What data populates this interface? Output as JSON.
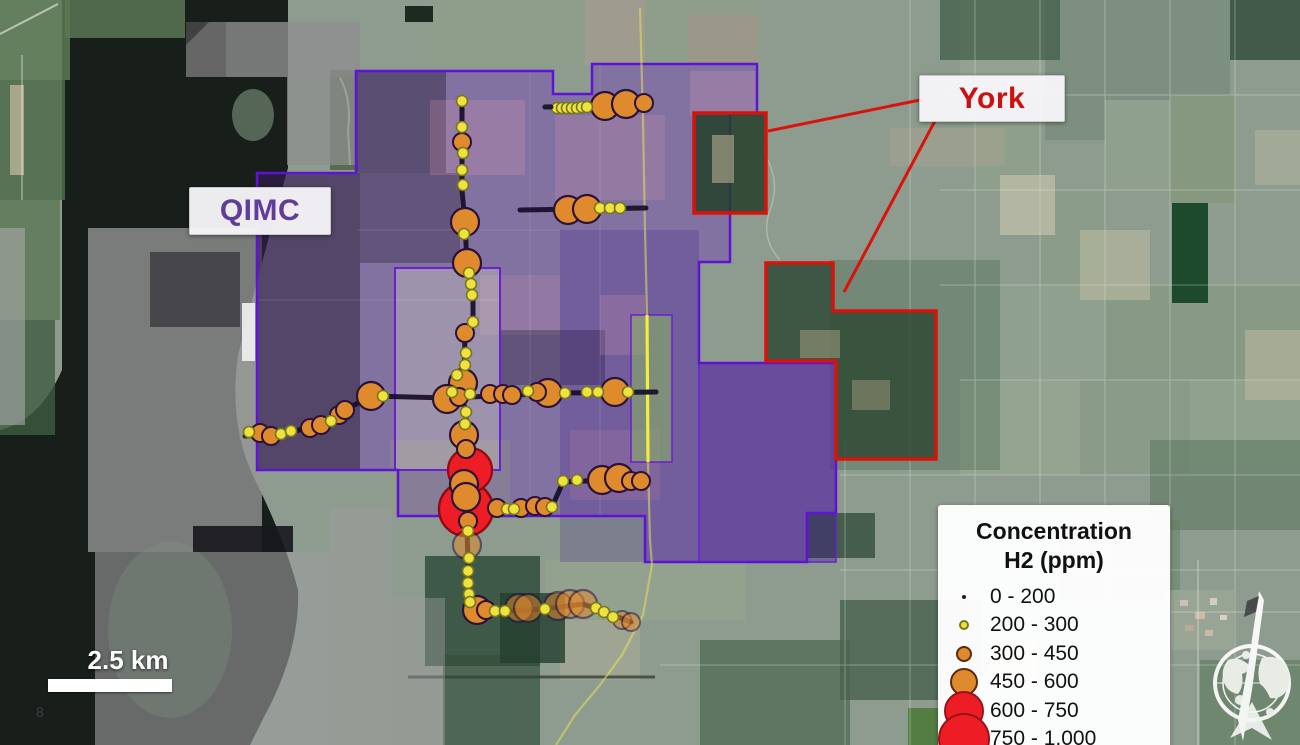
{
  "map": {
    "labels": {
      "qimc": "QIMC",
      "york": "York"
    },
    "scale_bar": {
      "label": "2.5 km"
    },
    "page_number": "8",
    "colors": {
      "qimc_outline": "#5e13d6",
      "qimc_label_text": "#5f3d99",
      "york_outline": "#d8130c",
      "york_label_text": "#cc1111",
      "dot_yellow": "#f0e23c",
      "dot_orange": "#e08a2e",
      "dot_red": "#ee1c24",
      "road_yellow": "#f1ea4a"
    },
    "legend": {
      "title_line1": "Concentration",
      "title_line2": "H2 (ppm)",
      "items": [
        {
          "range": "0 - 200",
          "color": "#1c1c30",
          "stroke": null,
          "radius": 2
        },
        {
          "range": "200 - 300",
          "color": "#f0e23c",
          "stroke": "#77771f",
          "radius": 5
        },
        {
          "range": "300 - 450",
          "color": "#e08a2e",
          "stroke": "#5a2a10",
          "radius": 8
        },
        {
          "range": "450 - 600",
          "color": "#e08a2e",
          "stroke": "#5a2a10",
          "radius": 14
        },
        {
          "range": "600 - 750",
          "color": "#ee1c24",
          "stroke": "#99121a",
          "radius": 20
        },
        {
          "range": "750 - 1,000",
          "color": "#ee1c24",
          "stroke": "#99121a",
          "radius": 26
        }
      ]
    },
    "dot_radii": {
      "c1": 2.5,
      "c2": 5.5,
      "c3": 9,
      "c4": 14,
      "c5": 22,
      "c6": 27
    },
    "points": [
      {
        "x": 545,
        "y": 107,
        "c": "c1"
      },
      {
        "x": 551,
        "y": 107,
        "c": "c1"
      },
      {
        "x": 557,
        "y": 108,
        "c": "c2"
      },
      {
        "x": 562,
        "y": 108,
        "c": "c2"
      },
      {
        "x": 567,
        "y": 108,
        "c": "c2"
      },
      {
        "x": 572,
        "y": 108,
        "c": "c2"
      },
      {
        "x": 577,
        "y": 108,
        "c": "c2"
      },
      {
        "x": 582,
        "y": 107,
        "c": "c2"
      },
      {
        "x": 587,
        "y": 107,
        "c": "c2"
      },
      {
        "x": 605,
        "y": 106,
        "c": "c4"
      },
      {
        "x": 626,
        "y": 104,
        "c": "c4"
      },
      {
        "x": 644,
        "y": 103,
        "c": "c3"
      },
      {
        "x": 462,
        "y": 101,
        "c": "c2"
      },
      {
        "x": 462,
        "y": 127,
        "c": "c2"
      },
      {
        "x": 462,
        "y": 142,
        "c": "c3"
      },
      {
        "x": 463,
        "y": 153,
        "c": "c2"
      },
      {
        "x": 462,
        "y": 170,
        "c": "c2"
      },
      {
        "x": 463,
        "y": 185,
        "c": "c2"
      },
      {
        "x": 465,
        "y": 222,
        "c": "c4"
      },
      {
        "x": 464,
        "y": 234,
        "c": "c2"
      },
      {
        "x": 467,
        "y": 263,
        "c": "c4"
      },
      {
        "x": 469,
        "y": 273,
        "c": "c2"
      },
      {
        "x": 471,
        "y": 284,
        "c": "c2"
      },
      {
        "x": 472,
        "y": 295,
        "c": "c2"
      },
      {
        "x": 473,
        "y": 322,
        "c": "c2"
      },
      {
        "x": 465,
        "y": 333,
        "c": "c3"
      },
      {
        "x": 466,
        "y": 353,
        "c": "c2"
      },
      {
        "x": 465,
        "y": 365,
        "c": "c2"
      },
      {
        "x": 457,
        "y": 375,
        "c": "c2"
      },
      {
        "x": 463,
        "y": 383,
        "c": "c4"
      },
      {
        "x": 452,
        "y": 392,
        "c": "c2"
      },
      {
        "x": 470,
        "y": 394,
        "c": "c2"
      },
      {
        "x": 447,
        "y": 399,
        "c": "c4"
      },
      {
        "x": 459,
        "y": 397,
        "c": "c3"
      },
      {
        "x": 466,
        "y": 412,
        "c": "c2"
      },
      {
        "x": 465,
        "y": 424,
        "c": "c2"
      },
      {
        "x": 464,
        "y": 435,
        "c": "c4"
      },
      {
        "x": 466,
        "y": 449,
        "c": "c3"
      },
      {
        "x": 470,
        "y": 470,
        "c": "c5"
      },
      {
        "x": 464,
        "y": 484,
        "c": "c4"
      },
      {
        "x": 466,
        "y": 497,
        "c": "c4"
      },
      {
        "x": 466,
        "y": 509,
        "c": "c6"
      },
      {
        "x": 468,
        "y": 521,
        "c": "c3"
      },
      {
        "x": 468,
        "y": 531,
        "c": "c2"
      },
      {
        "x": 467,
        "y": 545,
        "c": "c4",
        "f": 1
      },
      {
        "x": 469,
        "y": 558,
        "c": "c2"
      },
      {
        "x": 468,
        "y": 571,
        "c": "c2"
      },
      {
        "x": 468,
        "y": 583,
        "c": "c2"
      },
      {
        "x": 469,
        "y": 594,
        "c": "c2"
      },
      {
        "x": 470,
        "y": 602,
        "c": "c2"
      },
      {
        "x": 568,
        "y": 210,
        "c": "c4"
      },
      {
        "x": 587,
        "y": 209,
        "c": "c4"
      },
      {
        "x": 600,
        "y": 208,
        "c": "c2"
      },
      {
        "x": 610,
        "y": 208,
        "c": "c2"
      },
      {
        "x": 620,
        "y": 208,
        "c": "c2"
      },
      {
        "x": 633,
        "y": 208,
        "c": "c1"
      },
      {
        "x": 642,
        "y": 208,
        "c": "c1"
      },
      {
        "x": 490,
        "y": 394,
        "c": "c3"
      },
      {
        "x": 503,
        "y": 394,
        "c": "c3"
      },
      {
        "x": 512,
        "y": 395,
        "c": "c3"
      },
      {
        "x": 528,
        "y": 391,
        "c": "c2"
      },
      {
        "x": 537,
        "y": 392,
        "c": "c3"
      },
      {
        "x": 548,
        "y": 393,
        "c": "c4"
      },
      {
        "x": 565,
        "y": 393,
        "c": "c2"
      },
      {
        "x": 587,
        "y": 392,
        "c": "c2"
      },
      {
        "x": 598,
        "y": 392,
        "c": "c2"
      },
      {
        "x": 615,
        "y": 392,
        "c": "c4"
      },
      {
        "x": 628,
        "y": 392,
        "c": "c2"
      },
      {
        "x": 640,
        "y": 392,
        "c": "c1"
      },
      {
        "x": 648,
        "y": 392,
        "c": "c1"
      },
      {
        "x": 656,
        "y": 392,
        "c": "c1"
      },
      {
        "x": 497,
        "y": 508,
        "c": "c3"
      },
      {
        "x": 507,
        "y": 509,
        "c": "c2"
      },
      {
        "x": 514,
        "y": 509,
        "c": "c2"
      },
      {
        "x": 521,
        "y": 508,
        "c": "c3"
      },
      {
        "x": 535,
        "y": 506,
        "c": "c3"
      },
      {
        "x": 545,
        "y": 507,
        "c": "c3"
      },
      {
        "x": 552,
        "y": 507,
        "c": "c2"
      },
      {
        "x": 563,
        "y": 481,
        "c": "c2"
      },
      {
        "x": 577,
        "y": 480,
        "c": "c2"
      },
      {
        "x": 602,
        "y": 480,
        "c": "c4"
      },
      {
        "x": 619,
        "y": 478,
        "c": "c4"
      },
      {
        "x": 631,
        "y": 481,
        "c": "c3"
      },
      {
        "x": 641,
        "y": 481,
        "c": "c3"
      },
      {
        "x": 249,
        "y": 432,
        "c": "c2"
      },
      {
        "x": 260,
        "y": 433,
        "c": "c3"
      },
      {
        "x": 271,
        "y": 436,
        "c": "c3"
      },
      {
        "x": 281,
        "y": 434,
        "c": "c2"
      },
      {
        "x": 291,
        "y": 431,
        "c": "c2"
      },
      {
        "x": 310,
        "y": 428,
        "c": "c3"
      },
      {
        "x": 321,
        "y": 425,
        "c": "c3"
      },
      {
        "x": 331,
        "y": 421,
        "c": "c2"
      },
      {
        "x": 339,
        "y": 415,
        "c": "c3"
      },
      {
        "x": 345,
        "y": 410,
        "c": "c3"
      },
      {
        "x": 371,
        "y": 396,
        "c": "c4"
      },
      {
        "x": 383,
        "y": 396,
        "c": "c2"
      },
      {
        "x": 477,
        "y": 610,
        "c": "c4"
      },
      {
        "x": 486,
        "y": 610,
        "c": "c3"
      },
      {
        "x": 495,
        "y": 611,
        "c": "c2"
      },
      {
        "x": 505,
        "y": 611,
        "c": "c2"
      },
      {
        "x": 519,
        "y": 608,
        "c": "c4",
        "f": 1
      },
      {
        "x": 528,
        "y": 608,
        "c": "c4",
        "f": 1
      },
      {
        "x": 545,
        "y": 609,
        "c": "c2"
      },
      {
        "x": 558,
        "y": 606,
        "c": "c4",
        "f": 1
      },
      {
        "x": 570,
        "y": 604,
        "c": "c4",
        "f": 1
      },
      {
        "x": 583,
        "y": 604,
        "c": "c4",
        "f": 1
      },
      {
        "x": 596,
        "y": 608,
        "c": "c2"
      },
      {
        "x": 604,
        "y": 612,
        "c": "c2"
      },
      {
        "x": 613,
        "y": 617,
        "c": "c2"
      },
      {
        "x": 622,
        "y": 620,
        "c": "c3",
        "f": 1
      },
      {
        "x": 631,
        "y": 622,
        "c": "c3",
        "f": 1
      }
    ]
  }
}
